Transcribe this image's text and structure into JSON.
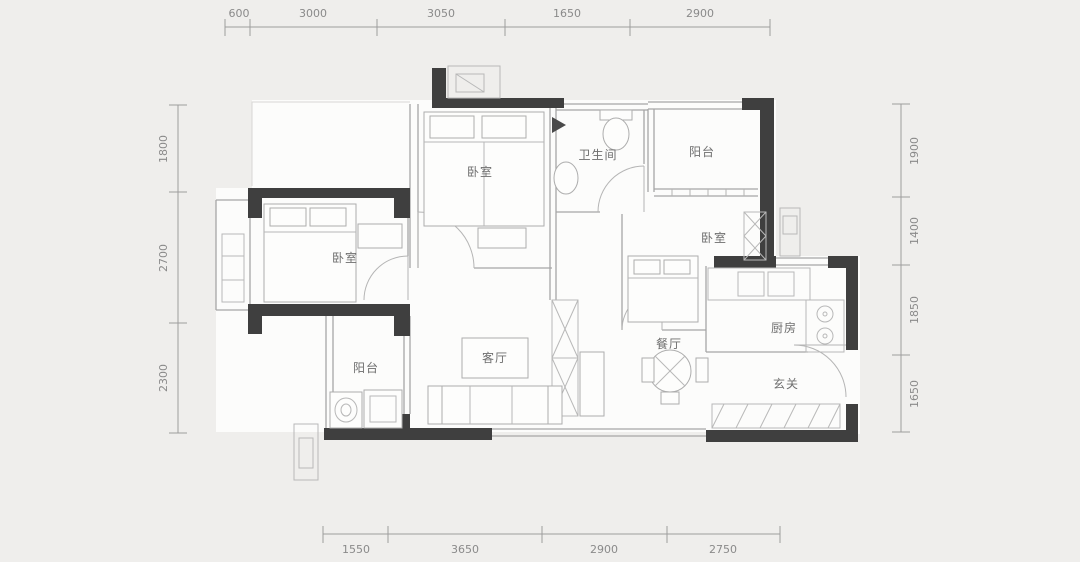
{
  "plan": {
    "type": "apartment-floor-plan",
    "units": "mm"
  },
  "dimensions": {
    "top": [
      "600",
      "3000",
      "3050",
      "1650",
      "2900"
    ],
    "left": [
      "1800",
      "2700",
      "2300"
    ],
    "right": [
      "1900",
      "1400",
      "1850",
      "1650"
    ],
    "bottom": [
      "1550",
      "3650",
      "2900",
      "2750"
    ]
  },
  "rooms": {
    "master_bedroom": "卧室",
    "bathroom": "卫生间",
    "balcony_top": "阳台",
    "bedroom_left": "卧室",
    "bedroom_right": "卧室",
    "living": "客厅",
    "dining": "餐厅",
    "kitchen": "厨房",
    "foyer": "玄关",
    "balcony_bottom": "阳台"
  },
  "colors": {
    "background": "#efeeec",
    "floor": "#fcfcfb",
    "wall": "#3f3f3f",
    "thin_line": "#a6a6a6",
    "dimension_text": "#8a8a8a",
    "room_text": "#6e6e6e"
  }
}
